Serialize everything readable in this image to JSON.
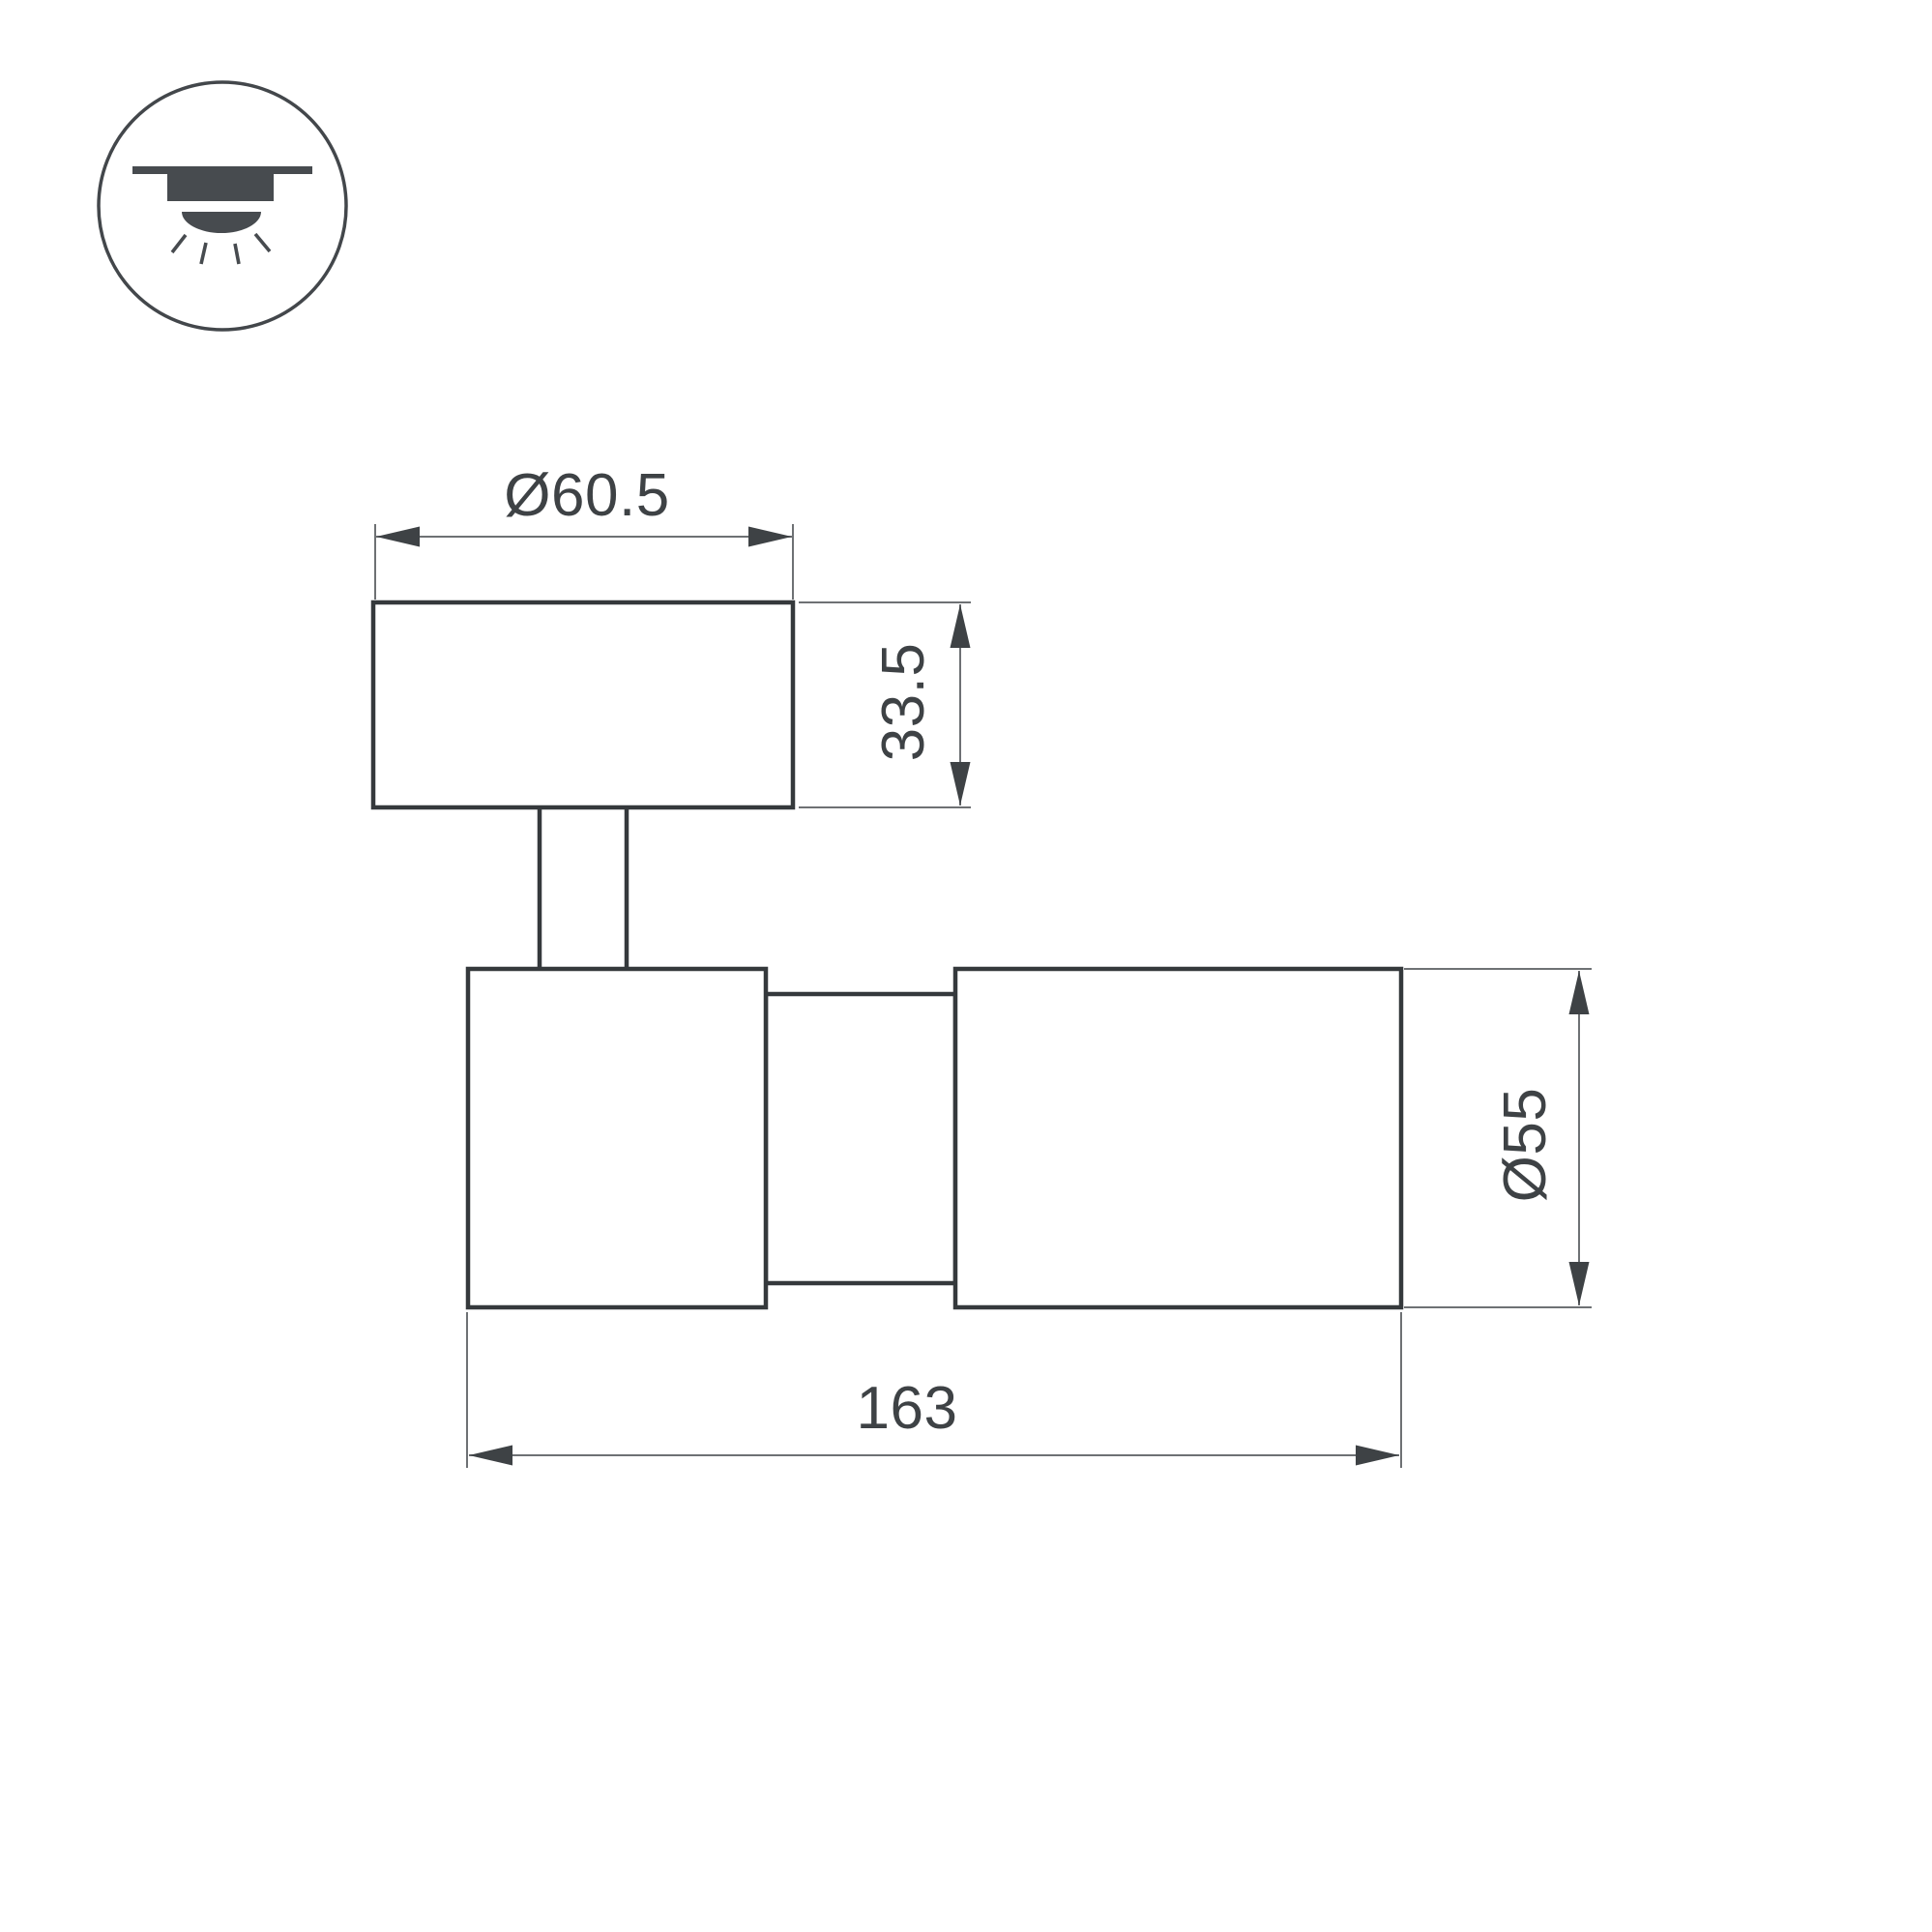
{
  "page": {
    "background": "#ffffff"
  },
  "colors": {
    "shape_line": "#35393c",
    "dim_line": "#6e7174",
    "ink": "#3e4245",
    "icon_fill": "#474b4f",
    "icon_stroke": "#43474b"
  },
  "icon": {
    "name": "ceiling-surface-mount-light"
  },
  "dimensions": {
    "top_diameter": "Ø60.5",
    "base_height": "33.5",
    "body_diameter": "Ø55",
    "total_length": "163"
  }
}
